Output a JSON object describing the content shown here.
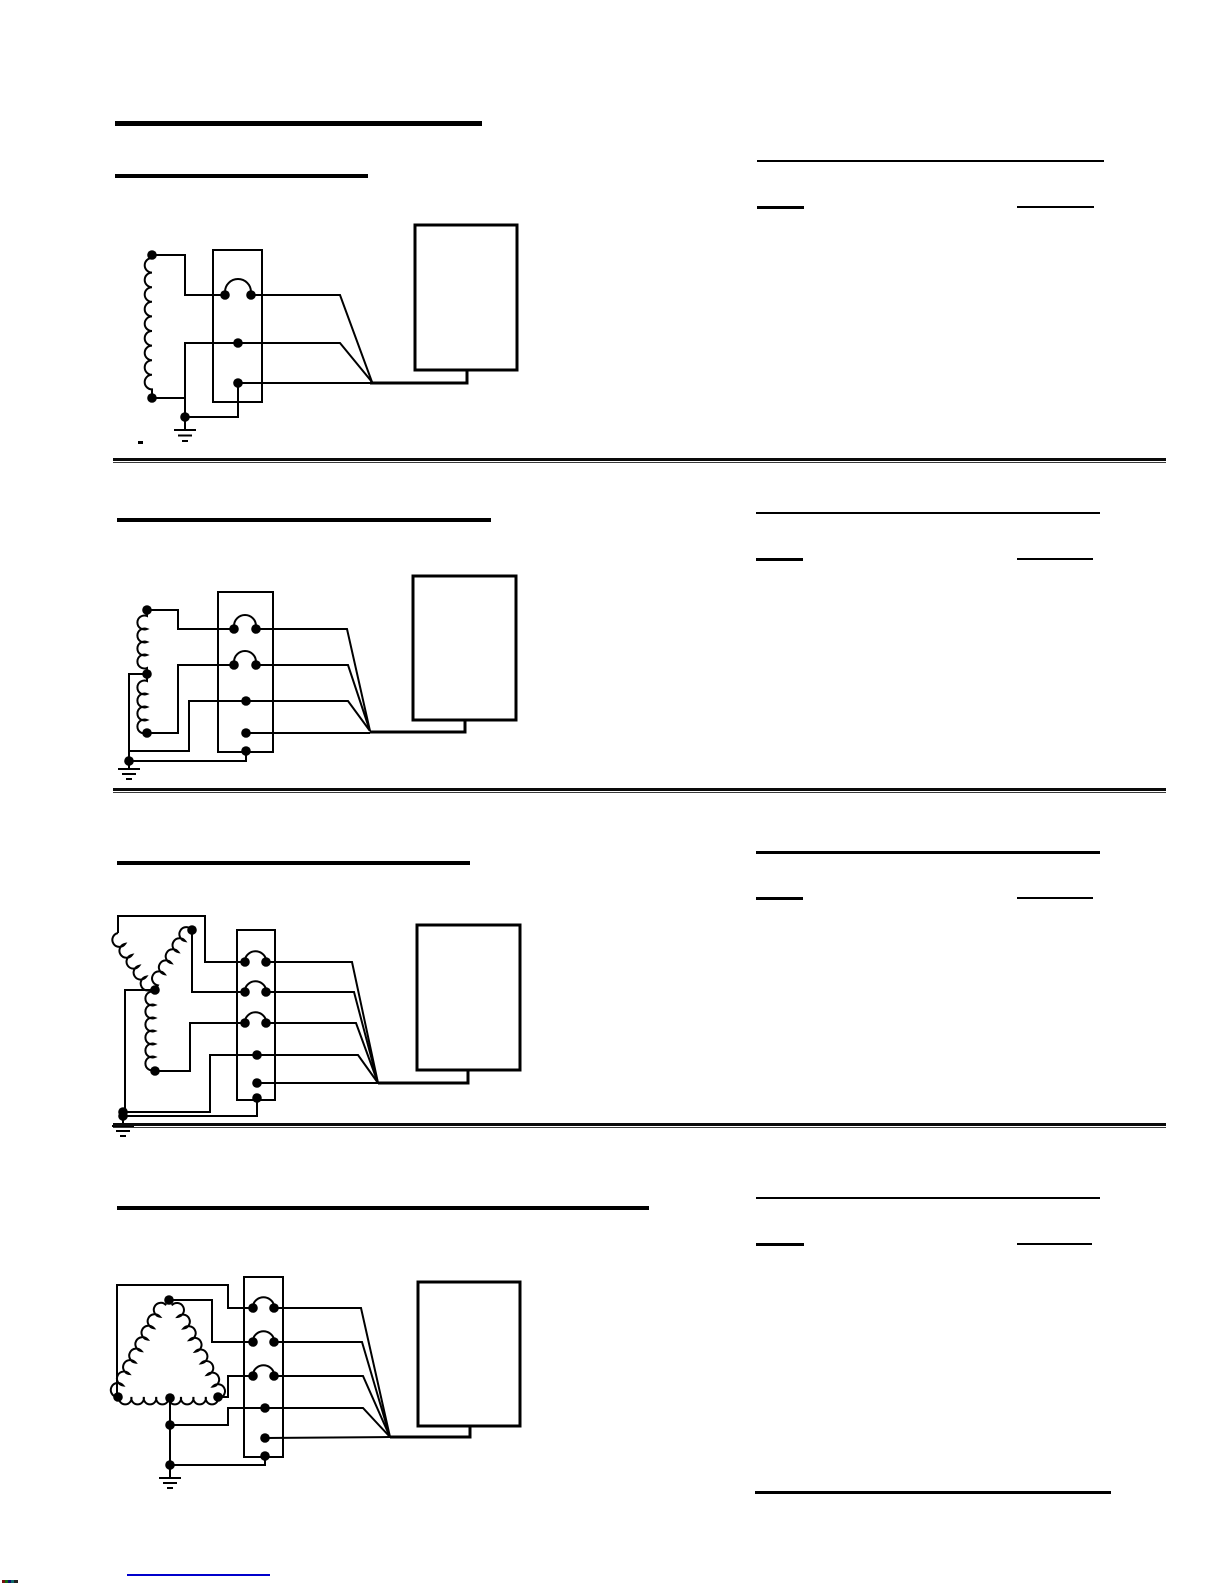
{
  "page": {
    "paper_color": "#ffffff",
    "ink_color": "#000000",
    "description": "manual page of transformer wiring diagrams; heading text not rendered, only underlines and rules visible"
  },
  "figures": [
    {
      "label": "single winding wired to 3-position terminal block with one jumper, wire bundle to equipment box, earth ground"
    },
    {
      "label": "two stacked windings wired to 4-position terminal block with two jumpers, wire bundle to equipment box, earth ground"
    },
    {
      "label": "wye-connected windings wired to 5-position terminal block with three jumpers, wire bundle to equipment box, earth ground"
    },
    {
      "label": "delta-connected windings wired to 5-position terminal block with three jumpers, wire bundle to equipment box, earth ground"
    }
  ],
  "footer": {
    "link_underline_color": "#0000cc"
  }
}
